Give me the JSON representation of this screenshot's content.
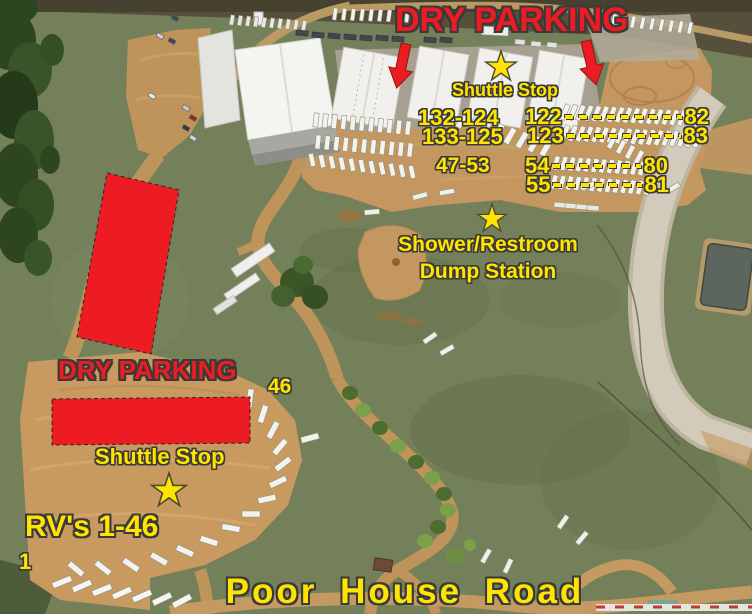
{
  "colors": {
    "red": "#ec1c22",
    "yellow": "#ffe400",
    "outline": "#3a3a3a"
  },
  "annotations": {
    "dry_parking_top": "DRY PARKING",
    "shuttle_stop_top": "Shuttle Stop",
    "row_labels": [
      "132-124",
      "133-125",
      "47-53"
    ],
    "dashed_rows": [
      {
        "from": "122",
        "to": "82"
      },
      {
        "from": "123",
        "to": "83"
      },
      {
        "from": "54",
        "to": "80"
      },
      {
        "from": "55",
        "to": "81"
      }
    ],
    "facility": {
      "line1": "Shower/Restroom",
      "line2": "Dump Station"
    },
    "dry_parking_left": "DRY PARKING",
    "shuttle_stop_left": "Shuttle Stop",
    "site_46": "46",
    "rv_range": "RV's 1-46",
    "site_1": "1",
    "road_name": "Poor House Road"
  },
  "icons": {
    "shuttle_stop_marker": "yellow-star",
    "facility_marker": "yellow-star",
    "direction_marker": "red-down-arrow",
    "dry_parking_zone": "red-rectangle"
  }
}
